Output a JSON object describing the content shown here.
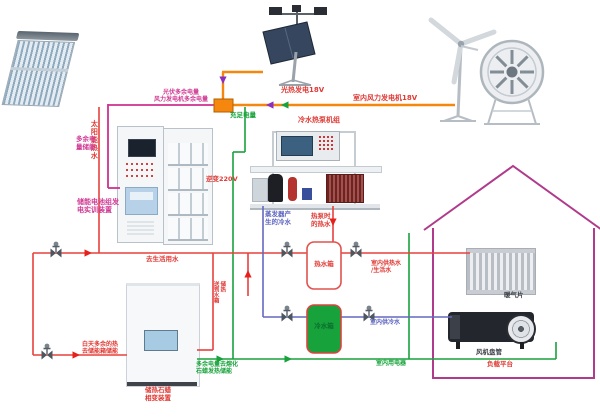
{
  "diagram": {
    "power": {
      "pv_label": "光热发电18V",
      "wind_label": "室内风力发电机18V",
      "surplus_note": "光伏多余电量\n风力发电机多余电量",
      "storage_note": "多余电\n量储能",
      "sufficient_note": "充足电量",
      "inverter_note": "逆变220V",
      "battery_device_label": "储能电池组发\n电实训装置",
      "paraffin_melt_note": "多余电量去熔化\n石蜡发热储能",
      "indoor_loads_note": "室内用电器"
    },
    "water": {
      "solar_hot_water": "太阳能热水",
      "heat_pump_label": "冷水热泵机组",
      "evaporator_cold": "蒸发器产\n生的冷水",
      "heat_pump_hot": "热泵时\n的热水",
      "domestic_water": "去生活用水",
      "day_surplus_heat": "白天多余的热\n去储能箱储能",
      "to_tank_storage": "送到水箱\n储热",
      "hot_tank": "热水箱",
      "cold_tank": "冷水箱",
      "indoor_hot_supply": "室内供热水\n/生活水",
      "indoor_cold_supply": "室内供冷水",
      "paraffin_device_label": "储热石蜡\n相变装置"
    },
    "house": {
      "radiator": "暖气片",
      "fan_coil": "风机盘管",
      "load_platform": "负载平台"
    },
    "colors": {
      "power_bus": "#f5870f",
      "surplus_line": "#cf2f8f",
      "grid_line": "#18a23b",
      "hot_pipe": "#e8413c",
      "cold_pipe": "#6468bf",
      "house_outline": "#b03a8c"
    }
  }
}
